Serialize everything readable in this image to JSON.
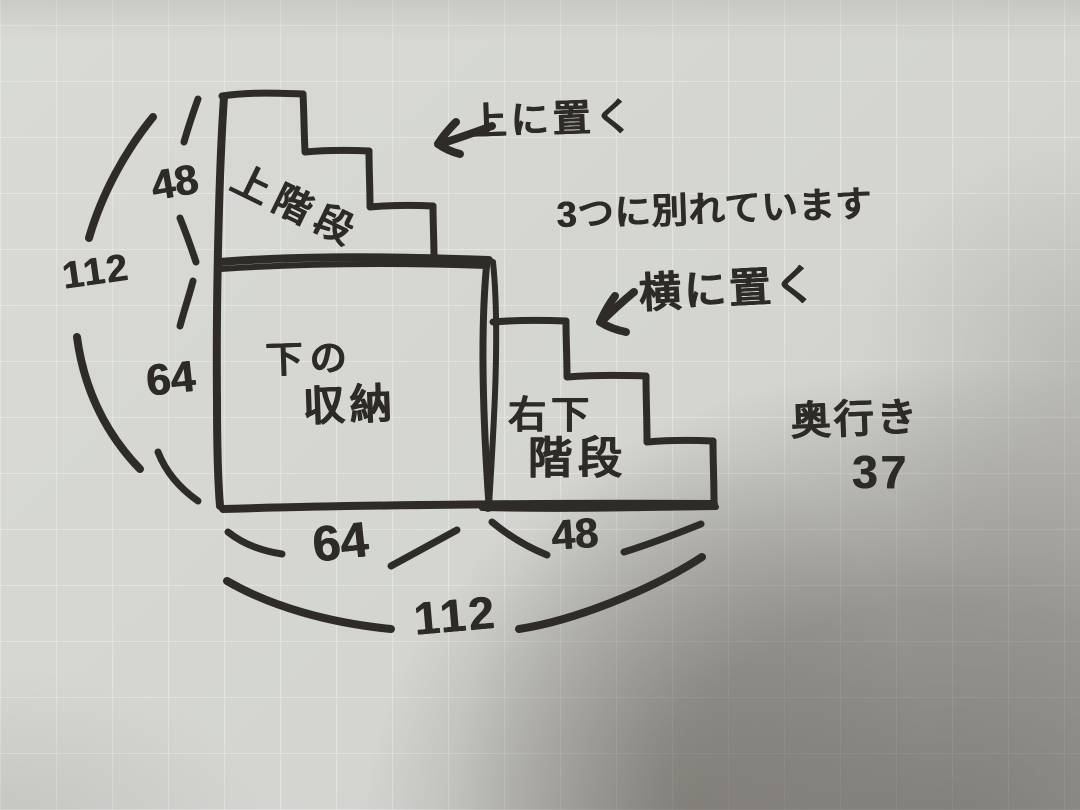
{
  "meta": {
    "description": "Hand-drawn marker sketch on gray graph paper of a 3-part staircase storage unit",
    "ink_color": "#2e2b28",
    "paper_color": "#d4d5d1",
    "shadow_color": "#6e6860"
  },
  "annotations": {
    "place_on_top": "上に置く",
    "split_note": "3つに別れています",
    "place_beside": "横に置く",
    "depth_label": "奥行き",
    "depth_value": "37"
  },
  "parts": {
    "upper_stairs": "上階段",
    "lower_storage_line1": "下の",
    "lower_storage_line2": "収納",
    "right_stairs_line1": "右下",
    "right_stairs_line2": "階段"
  },
  "dimensions": {
    "left_top_height": "48",
    "left_total_height": "112",
    "left_bottom_height": "64",
    "bottom_left_width": "64",
    "bottom_right_width": "48",
    "bottom_total_width": "112"
  }
}
